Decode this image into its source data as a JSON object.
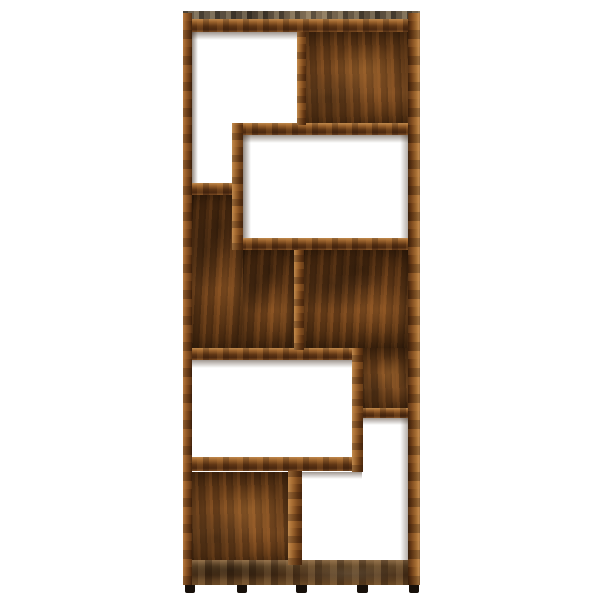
{
  "scene": {
    "subject": "geometric open bookshelf / room-divider shelving unit, front view",
    "finish": "smoked oak wood grain",
    "background": "plain white studio backdrop",
    "open_compartments": 5,
    "backed_compartments": 4,
    "feet_count": 5
  },
  "colors": {
    "background": "#ffffff",
    "edge_light": "#c08a4e",
    "edge_mid": "#9a622c",
    "edge_dark": "#4a2810",
    "panel_base": "#6b3f1a",
    "panel_dark": "#35200c",
    "top_surface_grey": "#6e6250",
    "foot": "#17100a"
  },
  "parts": [
    {
      "name": "back-panel-top-right",
      "type": "wood-panel",
      "variant": "b",
      "x": 303,
      "y": 32,
      "w": 105,
      "h": 93,
      "z": 1
    },
    {
      "name": "back-panel-left-middle-upper",
      "type": "wood-panel",
      "x": 192,
      "y": 195,
      "w": 51,
      "h": 155,
      "z": 1
    },
    {
      "name": "back-panel-left-middle-lower",
      "type": "wood-panel",
      "x": 243,
      "y": 250,
      "w": 51,
      "h": 100,
      "z": 1
    },
    {
      "name": "back-panel-right-middle",
      "type": "wood-panel",
      "x": 303,
      "y": 250,
      "w": 105,
      "h": 98,
      "z": 1
    },
    {
      "name": "back-panel-right-middle-notch",
      "type": "wood-panel",
      "variant": "b",
      "x": 363,
      "y": 348,
      "w": 45,
      "h": 62,
      "z": 1
    },
    {
      "name": "back-panel-bottom-left",
      "type": "wood-panel",
      "variant": "b",
      "x": 192,
      "y": 472,
      "w": 96,
      "h": 93,
      "z": 1
    },
    {
      "name": "shade-under-top-board",
      "type": "shade-h",
      "x": 192,
      "y": 32,
      "w": 105,
      "h": 8,
      "z": 2
    },
    {
      "name": "shade-under-shelf-c",
      "type": "shade-h",
      "x": 243,
      "y": 135,
      "w": 165,
      "h": 8,
      "z": 2
    },
    {
      "name": "shade-under-shelf-g",
      "type": "shade-h",
      "x": 192,
      "y": 360,
      "w": 160,
      "h": 8,
      "z": 2
    },
    {
      "name": "shade-under-shelf-i",
      "type": "shade-h",
      "x": 363,
      "y": 418,
      "w": 45,
      "h": 7,
      "z": 2
    },
    {
      "name": "shade-under-shelf-j",
      "type": "shade-h",
      "x": 302,
      "y": 472,
      "w": 60,
      "h": 7,
      "z": 2
    },
    {
      "name": "shade-board-b-side",
      "type": "shade-v",
      "x": 243,
      "y": 135,
      "w": 8,
      "h": 103,
      "z": 2
    },
    {
      "name": "shade-left-frame-inner",
      "type": "shade-v",
      "x": 192,
      "y": 32,
      "w": 6,
      "h": 151,
      "z": 2
    },
    {
      "name": "shade-right-frame-inner-upper",
      "type": "shade-v-r",
      "x": 400,
      "y": 135,
      "w": 8,
      "h": 103,
      "z": 2
    },
    {
      "name": "shade-right-frame-inner-lower",
      "type": "shade-v-r",
      "x": 400,
      "y": 418,
      "w": 8,
      "h": 144,
      "z": 2
    },
    {
      "name": "top-board-surface",
      "type": "top-surface",
      "x": 183,
      "y": 11,
      "w": 237,
      "h": 8,
      "z": 3
    },
    {
      "name": "top-board-front",
      "type": "wood-edge-h",
      "x": 183,
      "y": 19,
      "w": 237,
      "h": 13,
      "z": 3
    },
    {
      "name": "shelf-c-front",
      "type": "wood-edge-h",
      "x": 232,
      "y": 123,
      "w": 176,
      "h": 12,
      "z": 3
    },
    {
      "name": "step-shelf-d-front",
      "type": "wood-edge-h",
      "x": 183,
      "y": 183,
      "w": 60,
      "h": 12,
      "z": 3
    },
    {
      "name": "shelf-e-front",
      "type": "wood-edge-h",
      "x": 232,
      "y": 238,
      "w": 176,
      "h": 12,
      "z": 3
    },
    {
      "name": "shelf-g-front",
      "type": "wood-edge-h",
      "x": 183,
      "y": 348,
      "w": 180,
      "h": 12,
      "z": 3
    },
    {
      "name": "shelf-i-front",
      "type": "wood-edge-h",
      "x": 360,
      "y": 408,
      "w": 48,
      "h": 10,
      "z": 3
    },
    {
      "name": "shelf-j-front",
      "type": "wood-edge-h",
      "x": 183,
      "y": 457,
      "w": 179,
      "h": 14,
      "z": 3
    },
    {
      "name": "bottom-board-front",
      "type": "bottom-board",
      "x": 183,
      "y": 560,
      "w": 237,
      "h": 25,
      "z": 3
    },
    {
      "name": "left-side-frame",
      "type": "frame-left",
      "x": 183,
      "y": 13,
      "w": 9,
      "h": 572,
      "z": 4
    },
    {
      "name": "right-side-frame",
      "type": "frame-right",
      "x": 408,
      "y": 13,
      "w": 12,
      "h": 572,
      "z": 4
    },
    {
      "name": "divider-a-top",
      "type": "wood-edge-v",
      "x": 297,
      "y": 32,
      "w": 9,
      "h": 93,
      "z": 4
    },
    {
      "name": "board-b-vertical",
      "type": "wood-edge-v",
      "x": 232,
      "y": 123,
      "w": 11,
      "h": 127,
      "z": 4
    },
    {
      "name": "divider-f-middle",
      "type": "wood-edge-v",
      "x": 294,
      "y": 250,
      "w": 10,
      "h": 100,
      "z": 4
    },
    {
      "name": "board-h-vertical",
      "type": "wood-edge-v",
      "x": 352,
      "y": 348,
      "w": 11,
      "h": 124,
      "z": 4
    },
    {
      "name": "divider-k-bottom",
      "type": "wood-edge-v",
      "x": 288,
      "y": 471,
      "w": 14,
      "h": 94,
      "z": 4
    },
    {
      "name": "foot-1",
      "type": "foot",
      "x": 185,
      "y": 585,
      "w": 10,
      "h": 8,
      "z": 4
    },
    {
      "name": "foot-2",
      "type": "foot",
      "x": 237,
      "y": 585,
      "w": 10,
      "h": 8,
      "z": 4
    },
    {
      "name": "foot-3",
      "type": "foot",
      "x": 296,
      "y": 585,
      "w": 11,
      "h": 8,
      "z": 4
    },
    {
      "name": "foot-4",
      "type": "foot",
      "x": 357,
      "y": 585,
      "w": 11,
      "h": 8,
      "z": 4
    },
    {
      "name": "foot-5",
      "type": "foot",
      "x": 409,
      "y": 585,
      "w": 10,
      "h": 8,
      "z": 4
    }
  ]
}
